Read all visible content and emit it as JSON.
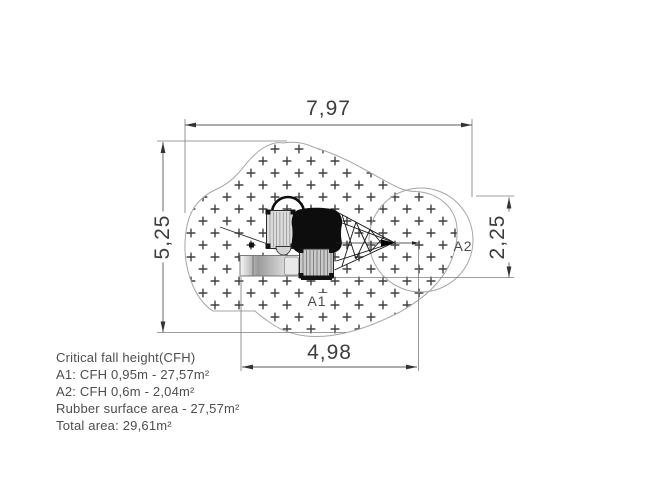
{
  "dimensions": {
    "top": "7,97",
    "left": "5,25",
    "bottom": "4,98",
    "right": "2,25"
  },
  "area_labels": {
    "a1": "A1",
    "a2": "A2"
  },
  "notes": {
    "heading": "Critical fall height(CFH)",
    "a1_line": "A1: CFH 0,95m - 27,57m²",
    "a2_line": "A2: CFH 0,6m - 2,04m²",
    "rubber_line": "Rubber surface area - 27,57m²",
    "total_line": "Total area: 29,61m²"
  },
  "colors": {
    "outline": "#a6a6a6",
    "dimension_line": "#5a5a5a",
    "extension_line": "#7c7c7c",
    "pattern_cross": "#3f3f3f",
    "structure": "#0d0d0d",
    "text": "#4d4d4d"
  }
}
